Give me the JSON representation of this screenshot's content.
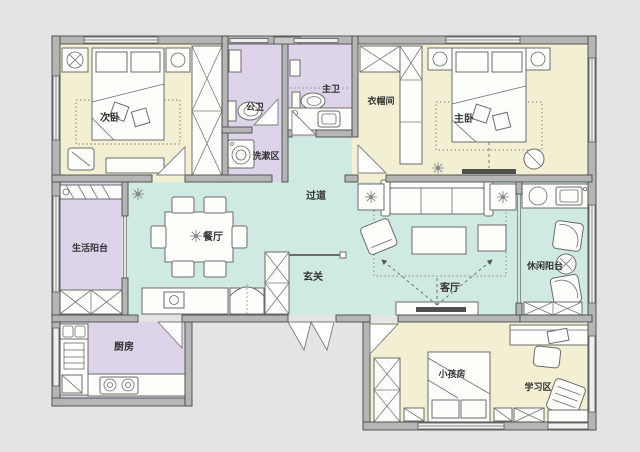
{
  "floorplan": {
    "type": "apartment-floor-plan",
    "colors": {
      "outside": "#e4e4e4",
      "wall_fill": "#b5b5b5",
      "wall_line": "#4a4a4a",
      "bedroom_floor": "#f2efd3",
      "bath_floor": "#ddd4ea",
      "living_floor": "#cfe9e3",
      "furniture": "#fdfdfa",
      "tv_accent": "#4f4f4f"
    },
    "rooms": [
      {
        "id": "second-bedroom",
        "label": "次卧"
      },
      {
        "id": "public-bathroom",
        "label": "公卫"
      },
      {
        "id": "master-bathroom",
        "label": "主卫"
      },
      {
        "id": "cloakroom",
        "label": "衣帽间"
      },
      {
        "id": "master-bedroom",
        "label": "主卧"
      },
      {
        "id": "wash-area",
        "label": "洗漱区"
      },
      {
        "id": "corridor",
        "label": "过道"
      },
      {
        "id": "service-balcony",
        "label": "生活阳台"
      },
      {
        "id": "dining-room",
        "label": "餐厅"
      },
      {
        "id": "entryway",
        "label": "玄关"
      },
      {
        "id": "living-room",
        "label": "客厅"
      },
      {
        "id": "leisure-balcony",
        "label": "休闲阳台"
      },
      {
        "id": "kitchen",
        "label": "厨房"
      },
      {
        "id": "kids-room",
        "label": "小孩房"
      },
      {
        "id": "study-area",
        "label": "学习区"
      }
    ]
  }
}
